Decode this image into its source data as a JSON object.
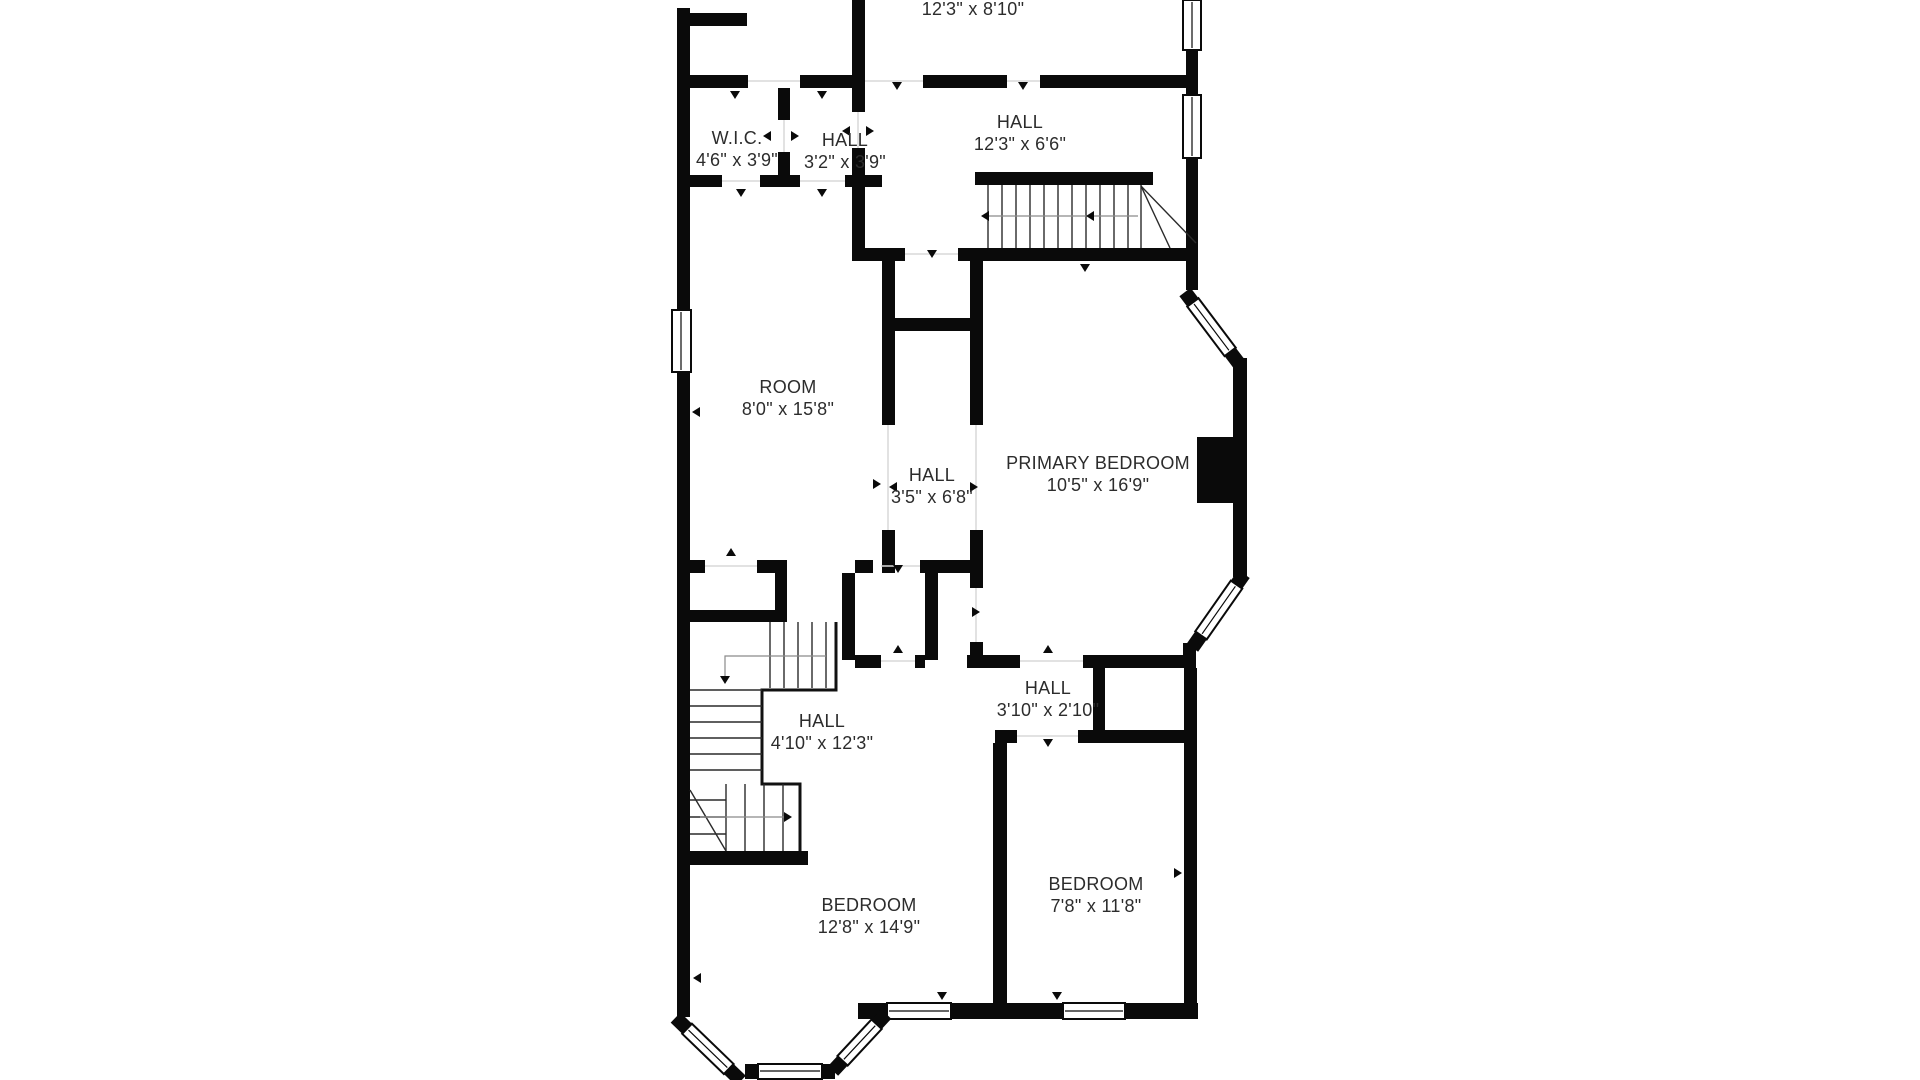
{
  "plan": {
    "type": "floor-plan",
    "background_color": "#ffffff",
    "wall_color": "#0a0a0a",
    "label_color": "#2c2c2c"
  },
  "rooms": [
    {
      "id": "top-room",
      "name": "",
      "dims": "12'3\" x 8'10\""
    },
    {
      "id": "wic",
      "name": "W.I.C.",
      "dims": "4'6\" x 3'9\""
    },
    {
      "id": "hall-upper",
      "name": "HALL",
      "dims": "3'2\" x 3'9\""
    },
    {
      "id": "hall-landing",
      "name": "HALL",
      "dims": "12'3\" x 6'6\""
    },
    {
      "id": "room",
      "name": "ROOM",
      "dims": "8'0\" x 15'8\""
    },
    {
      "id": "hall-center",
      "name": "HALL",
      "dims": "3'5\" x 6'8\""
    },
    {
      "id": "primary-bedroom",
      "name": "PRIMARY BEDROOM",
      "dims": "10'5\" x 16'9\""
    },
    {
      "id": "hall-small",
      "name": "HALL",
      "dims": "3'10\" x 2'10\""
    },
    {
      "id": "hall-stairs",
      "name": "HALL",
      "dims": "4'10\" x 12'3\""
    },
    {
      "id": "bedroom-left",
      "name": "BEDROOM",
      "dims": "12'8\" x 14'9\""
    },
    {
      "id": "bedroom-right",
      "name": "BEDROOM",
      "dims": "7'8\" x 11'8\""
    }
  ]
}
